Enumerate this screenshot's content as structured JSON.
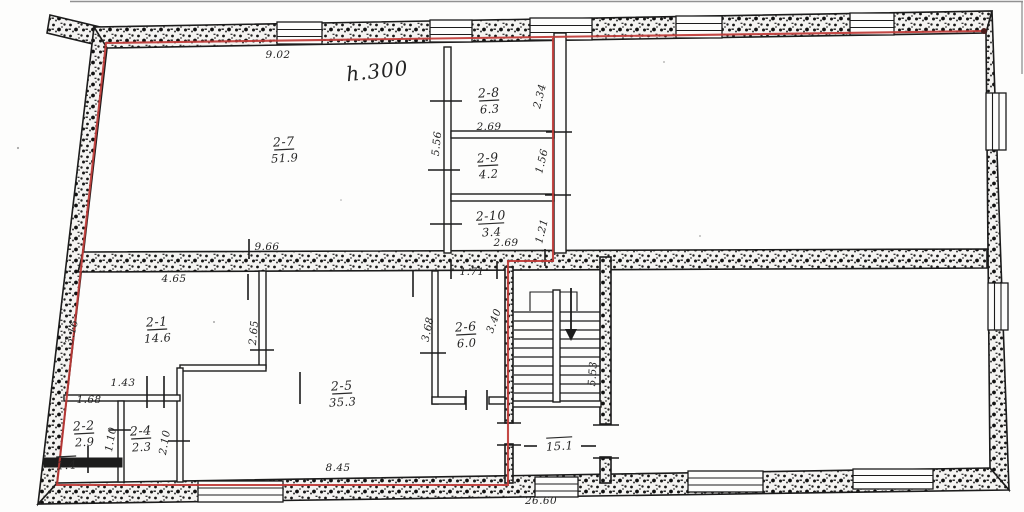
{
  "meta": {
    "document_type": "scanned floor plan drawing",
    "floor_note": "h.300",
    "overall_width": "26.60"
  },
  "colors": {
    "ink": "#1c1c1c",
    "red": "#bf3a36",
    "paper": "#fdfdfc"
  },
  "plan": {
    "rooms": [
      {
        "num": "2-7",
        "area": "51.9",
        "x": 284,
        "y": 146
      },
      {
        "num": "2-8",
        "area": "6.3",
        "x": 489,
        "y": 97
      },
      {
        "num": "2-9",
        "area": "4.2",
        "x": 488,
        "y": 162
      },
      {
        "num": "2-10",
        "area": "3.4",
        "x": 491,
        "y": 220
      },
      {
        "num": "2-1",
        "area": "14.6",
        "x": 157,
        "y": 326
      },
      {
        "num": "2-2",
        "area": "2.9",
        "x": 84,
        "y": 430
      },
      {
        "num": "2-4",
        "area": "2.3",
        "x": 141,
        "y": 435
      },
      {
        "num": "2-5",
        "area": "35.3",
        "x": 342,
        "y": 390
      },
      {
        "num": "2-6",
        "area": "6.0",
        "x": 466,
        "y": 331
      },
      {
        "num": "",
        "area": "15.1",
        "x": 559,
        "y": 434
      },
      {
        "num": "",
        "area": "1.4",
        "x": 66,
        "y": 453
      }
    ],
    "dimensions": [
      {
        "text": "9.02",
        "x": 278,
        "y": 58
      },
      {
        "text": "h.300",
        "x": 378,
        "y": 78,
        "rot": -6,
        "cls": "note",
        "name": "ceiling-height-note"
      },
      {
        "text": "5.56",
        "x": 440,
        "y": 144,
        "rot": -84
      },
      {
        "text": "2.69",
        "x": 489,
        "y": 130
      },
      {
        "text": "2.34",
        "x": 543,
        "y": 97,
        "rot": -76
      },
      {
        "text": "1.56",
        "x": 545,
        "y": 162,
        "rot": -76
      },
      {
        "text": "1.21",
        "x": 545,
        "y": 232,
        "rot": -76
      },
      {
        "text": "9.66",
        "x": 267,
        "y": 250
      },
      {
        "text": "2.69",
        "x": 506,
        "y": 246
      },
      {
        "text": "4.65",
        "x": 174,
        "y": 282
      },
      {
        "text": "3.16",
        "x": 75,
        "y": 333,
        "rot": -75
      },
      {
        "text": "2.65",
        "x": 257,
        "y": 333,
        "rot": -85
      },
      {
        "text": "1.71",
        "x": 472,
        "y": 275
      },
      {
        "text": "3.68",
        "x": 431,
        "y": 330,
        "rot": -78
      },
      {
        "text": "3.40",
        "x": 497,
        "y": 322,
        "rot": -70
      },
      {
        "text": "1.43",
        "x": 123,
        "y": 386
      },
      {
        "text": "1.68",
        "x": 89,
        "y": 403
      },
      {
        "text": "1.10",
        "x": 114,
        "y": 440,
        "rot": -80
      },
      {
        "text": "2.10",
        "x": 168,
        "y": 443,
        "rot": -80
      },
      {
        "text": "8.45",
        "x": 338,
        "y": 471
      },
      {
        "text": "5.53",
        "x": 596,
        "y": 374,
        "rot": -86
      },
      {
        "text": "26.60",
        "x": 541,
        "y": 504,
        "name": "overall-width-dimension"
      }
    ]
  }
}
